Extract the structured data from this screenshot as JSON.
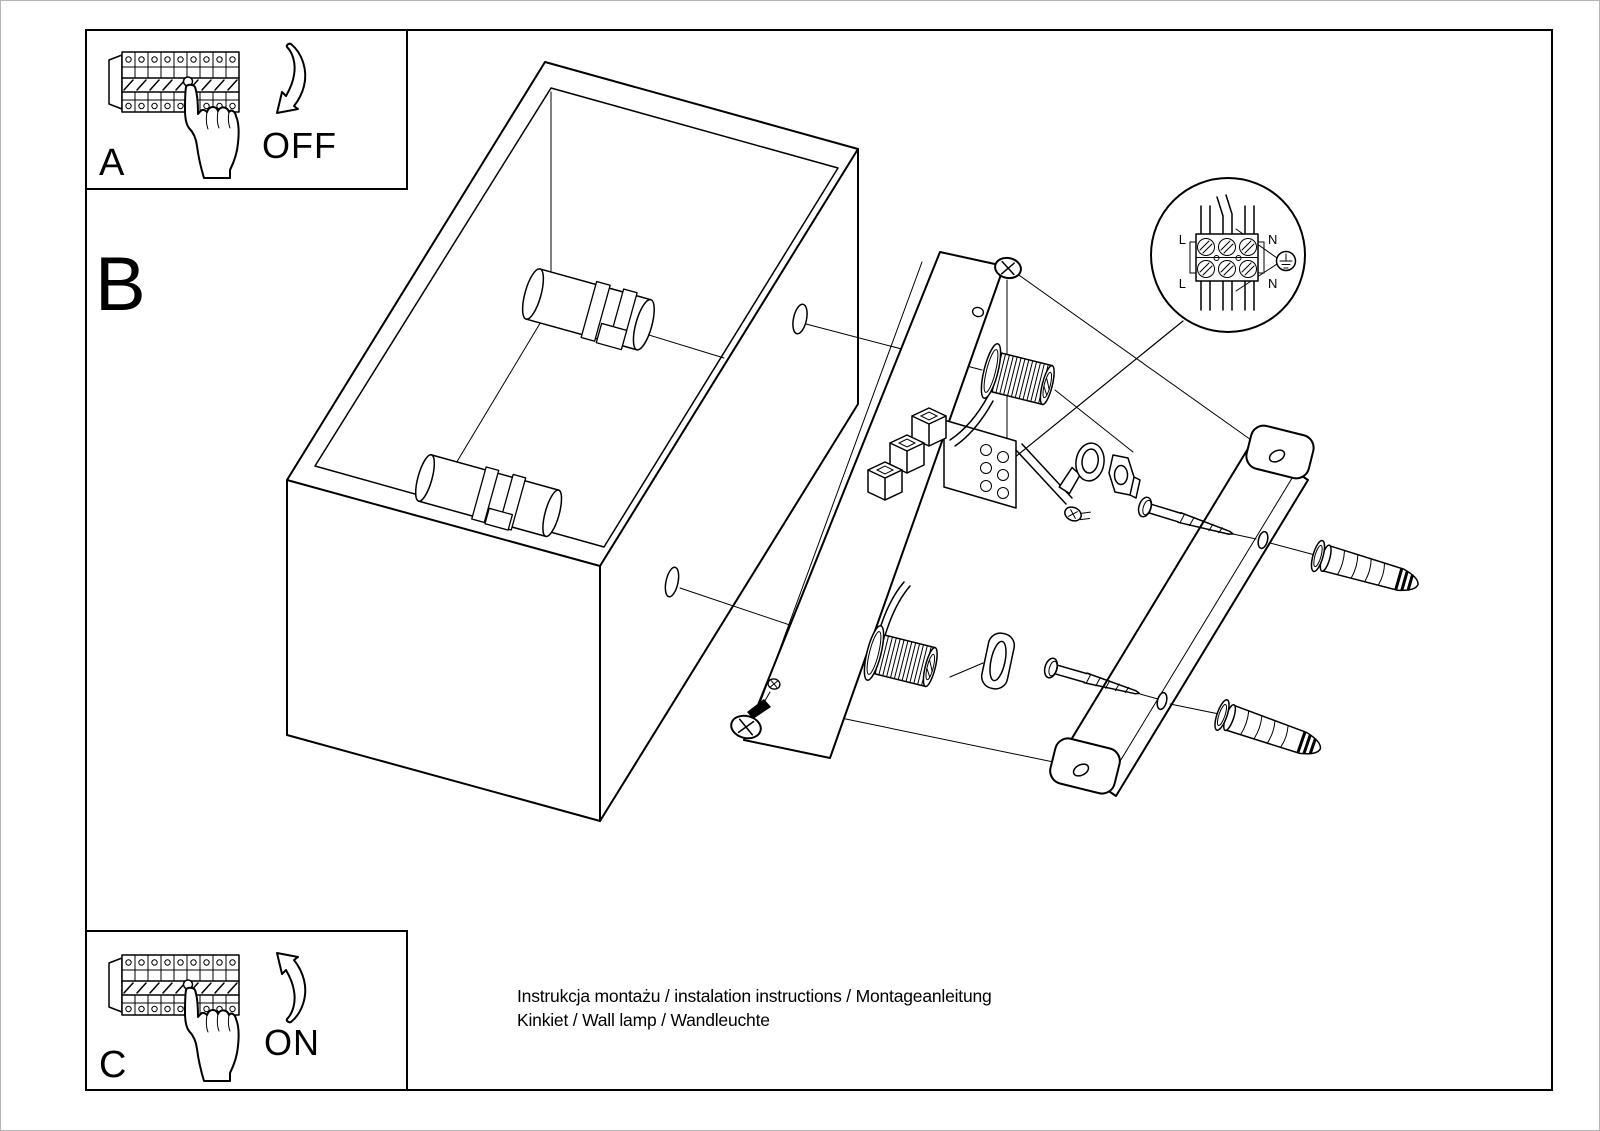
{
  "page": {
    "background": "#ffffff",
    "ink": "#000000"
  },
  "step_a": {
    "label": "A",
    "action": "OFF",
    "icon": "circuit-breaker-panel-icon",
    "hand_icon": "pressing-hand-icon",
    "arrow_icon": "curved-arrow-down-icon"
  },
  "step_b": {
    "label": "B"
  },
  "step_c": {
    "label": "C",
    "action": "ON",
    "icon": "circuit-breaker-panel-icon",
    "hand_icon": "pressing-hand-icon",
    "arrow_icon": "curved-arrow-up-icon"
  },
  "wiring_detail": {
    "l_top": "L",
    "n_top": "N",
    "l_bottom": "L",
    "n_bottom": "N",
    "ground_icon": "earth-ground-icon"
  },
  "footer": {
    "line1": "Instrukcja montażu / instalation instructions / Montageanleitung",
    "line2": "Kinkiet / Wall lamp / Wandleuchte"
  }
}
